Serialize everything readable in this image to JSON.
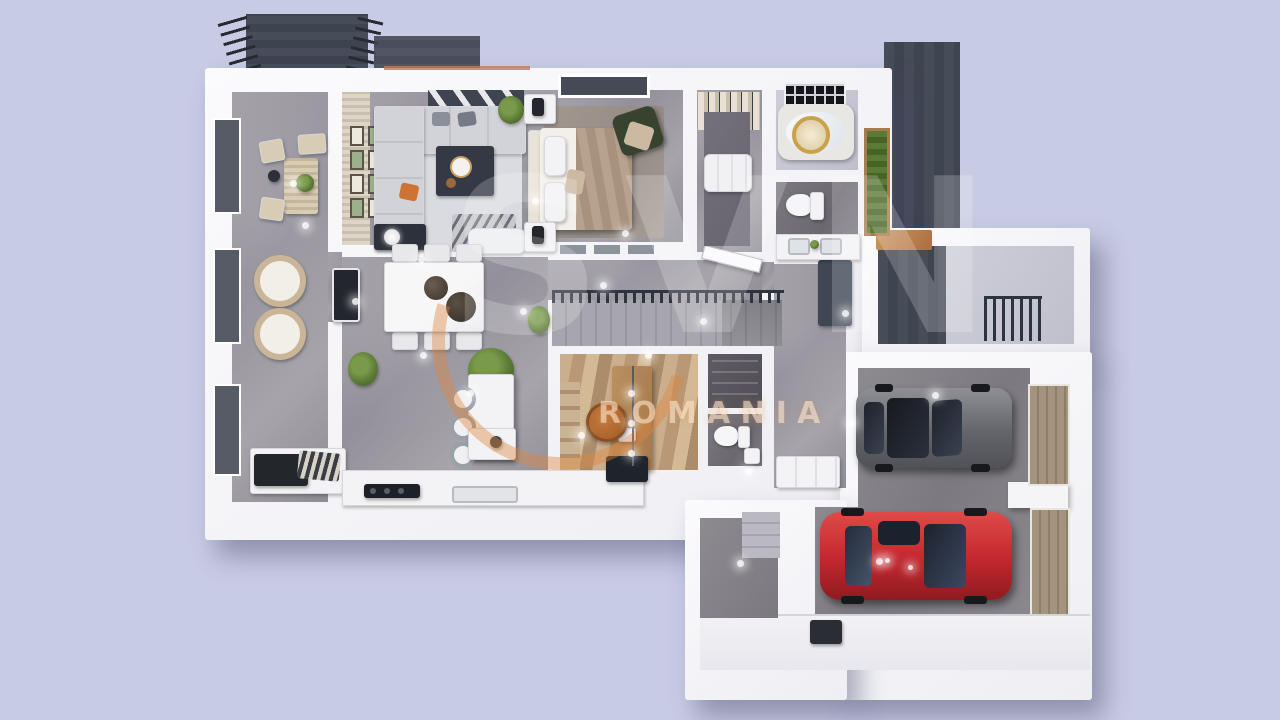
{
  "watermark": {
    "logo": "SVN",
    "region": "ROMANIA"
  },
  "colors": {
    "background": "#c8cbe4",
    "wall": "#f7f7f9",
    "concrete": "#9b98a0",
    "deck": "#474c59",
    "garage_door": "#a3937f",
    "wood": "#c0855a",
    "greenery": "#5b7a35",
    "car_red": "#c1272d",
    "car_gray": "#63656b",
    "accent_orange": "#e1853e"
  }
}
